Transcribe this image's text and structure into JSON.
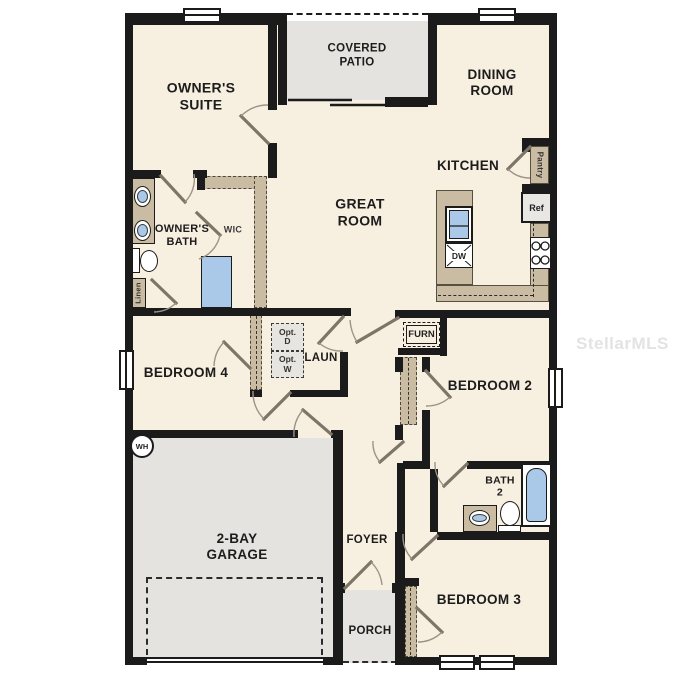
{
  "watermark": "StellarMLS",
  "colors": {
    "wall": "#1b1b1b",
    "floor": "#f7efe0",
    "concrete_gray": "#e4e3e0",
    "counter_tan": "#c9bca2",
    "fixture_blue": "#aac9e9",
    "watermark_gray": "#e3e3e3"
  },
  "rooms": {
    "owners_suite": [
      "OWNER'S",
      "SUITE"
    ],
    "covered_patio": [
      "COVERED",
      "PATIO"
    ],
    "dining_room": [
      "DINING",
      "ROOM"
    ],
    "kitchen": [
      "KITCHEN"
    ],
    "great_room": [
      "GREAT",
      "ROOM"
    ],
    "owners_bath": [
      "OWNER'S",
      "BATH"
    ],
    "wic": [
      "WIC"
    ],
    "bedroom4": [
      "BEDROOM 4"
    ],
    "laundry": [
      "LAUN"
    ],
    "bedroom2": [
      "BEDROOM 2"
    ],
    "garage": [
      "2-BAY",
      "GARAGE"
    ],
    "foyer": [
      "FOYER"
    ],
    "bath2": [
      "BATH",
      "2"
    ],
    "bedroom3": [
      "BEDROOM 3"
    ],
    "porch": [
      "PORCH"
    ]
  },
  "fixtures": {
    "pantry": "Pantry",
    "ref": "Ref",
    "dw": "DW",
    "linen": "Linen",
    "furn": "FURN",
    "wh": "WH",
    "opt_dryer": [
      "Opt.",
      "D"
    ],
    "opt_washer": [
      "Opt.",
      "W"
    ]
  }
}
